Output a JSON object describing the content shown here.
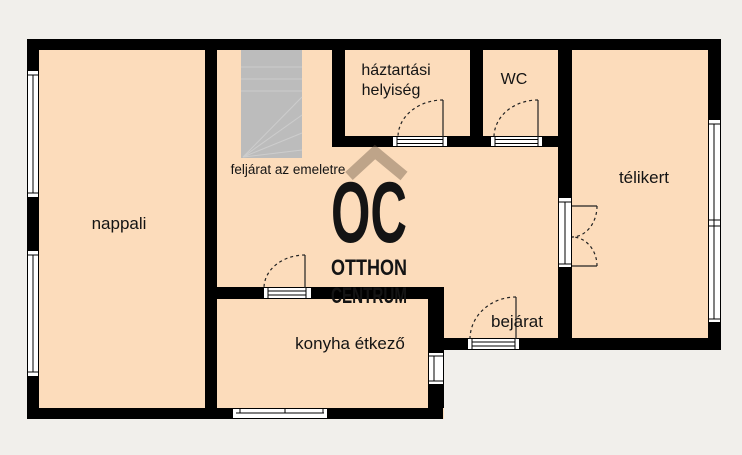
{
  "palette": {
    "background": "#f1efeb",
    "floor": "#fcdcbb",
    "wall": "#000000",
    "stairs": "#bcbcbc",
    "stair_line": "#cdcdcd",
    "window_fill": "#ffffff",
    "outline": "#000000",
    "door_line": "#222222",
    "label": "#141414",
    "watermark": "rgba(105,86,68,0.42)"
  },
  "labels": {
    "nappali": "nappali",
    "stairs_note": "feljárat az emeletre",
    "haztartasi_line1": "háztartási",
    "haztartasi_line2": "helyiség",
    "wc": "WC",
    "telikert": "télikert",
    "konyha": "konyha étkező",
    "bejarat": "bejárat"
  },
  "watermark": {
    "monogram": "OC",
    "line1": "OTTHON",
    "line2": "CENTRUM"
  }
}
